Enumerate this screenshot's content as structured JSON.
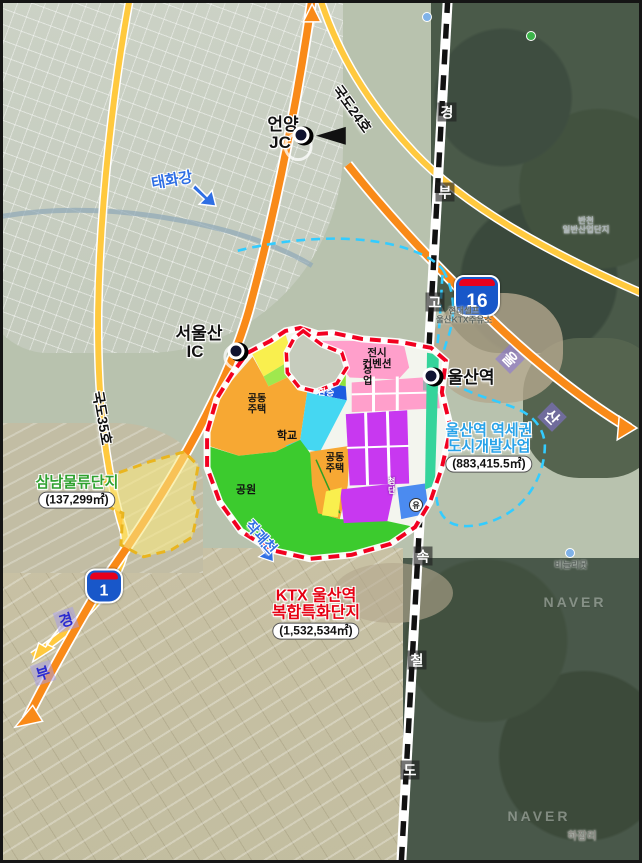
{
  "title": "KTX 울산역 복합특화단지 위치도",
  "colors": {
    "site_boundary": "#f20020",
    "metro_zone_boundary": "#33ccff",
    "logistics_zone_boundary": "#e9b51f",
    "expressway": "#f98a18",
    "national_route": "#ffc93e",
    "rail_line": "#111111"
  },
  "markers": {
    "eonyang": {
      "line1": "언양",
      "line2": "JC"
    },
    "seoulsan": {
      "line1": "서울산",
      "line2": "IC"
    },
    "ulsan_station": {
      "label": "울산역"
    }
  },
  "rivers": {
    "taehwa": "태화강",
    "jakgwae": "작괘천"
  },
  "roads": {
    "route24": "국도24호",
    "route35": "국도35호",
    "shield16": "16",
    "shield1": "1",
    "ulsan_chars": [
      "울",
      "산"
    ],
    "gyeongbu_chars": [
      "경",
      "부"
    ]
  },
  "rail": {
    "chars": [
      "경",
      "부",
      "고",
      "속",
      "철",
      "도"
    ]
  },
  "zones": {
    "samnam": {
      "name": "삼남물류단지",
      "area": "(137,299㎡)"
    },
    "yeokse": {
      "line1": "울산역 역세권",
      "line2": "도시개발사업",
      "area": "(883,415.5㎡)"
    },
    "ktx": {
      "line1": "KTX 울산역",
      "line2": "복합특화단지",
      "area": "(1,532,534㎡)"
    }
  },
  "landuse": {
    "res1_l1": "공동",
    "res1_l2": "주택",
    "school": "학교",
    "res2_l1": "공동",
    "res2_l2": "주택",
    "park": "공원",
    "conv_l1": "전시",
    "conv_l2": "컨벤션",
    "commercial": "상업",
    "hightech": "첨단",
    "transfer": "환승",
    "circle_mark": "유"
  },
  "poi": {
    "gas_l1": "현대셀프",
    "gas_l2": "울산KTX주유소",
    "pond": "비늘리못",
    "hajamri": "하잠리",
    "bancheon_l1": "반천",
    "bancheon_l2": "일반산업단지",
    "watermark": "NAVER"
  }
}
